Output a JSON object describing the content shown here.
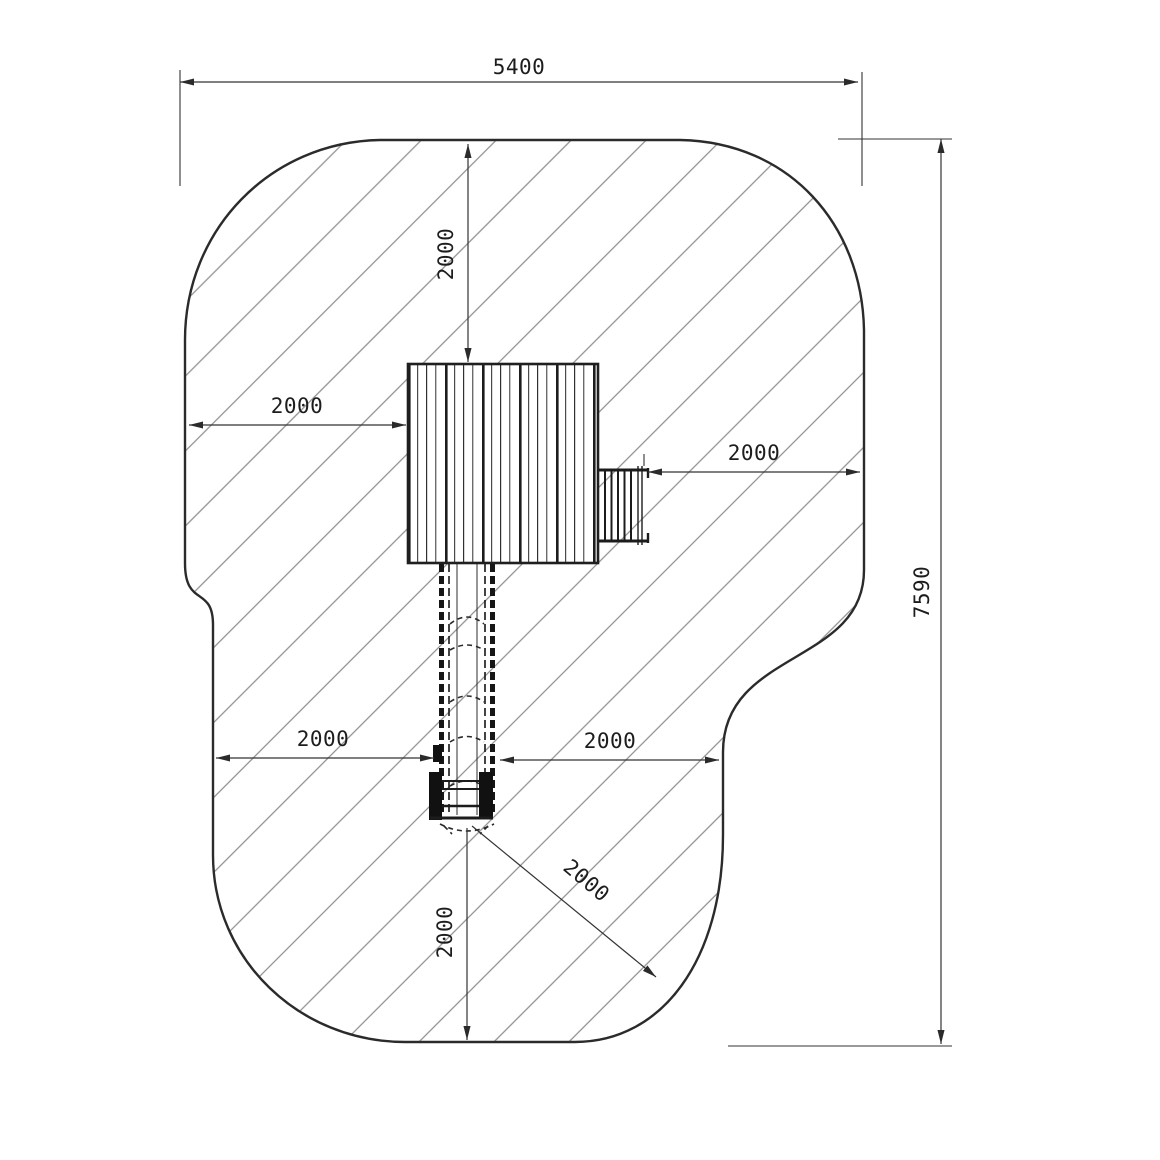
{
  "drawing": {
    "title": "playground-equipment-safety-area-plan",
    "labels": {
      "width_top": "5400",
      "height_right": "7590",
      "clearance_top": "2000",
      "clearance_left": "2000",
      "clearance_right": "2000",
      "clearance_lower_left": "2000",
      "clearance_lower_right": "2000",
      "clearance_bottom": "2000",
      "clearance_slide_exit": "2000"
    },
    "colors": {
      "ink": "#2b2b2b",
      "dim": "#333333",
      "hatch": "#8f8f8f",
      "bg": "#ffffff",
      "text": "#1d1d1d"
    }
  }
}
